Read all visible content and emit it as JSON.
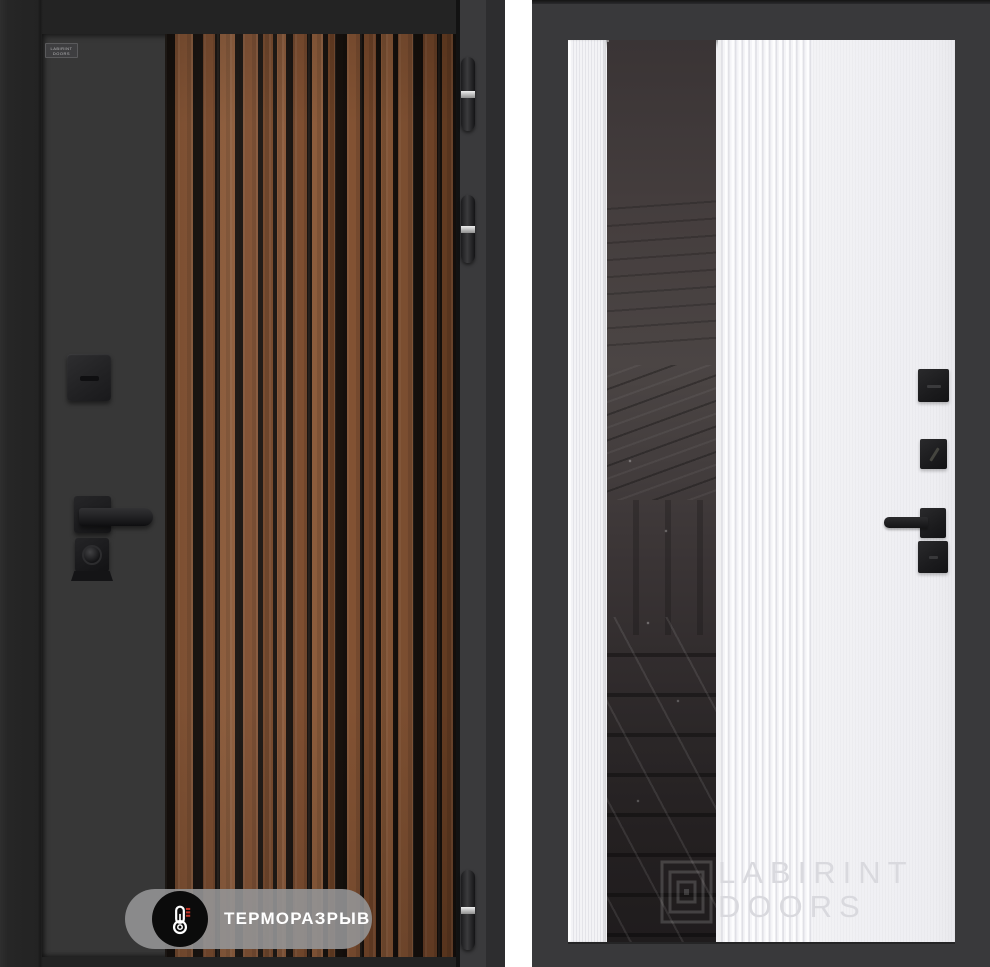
{
  "page": {
    "background": "#ffffff",
    "description_left": "dark entry door with vertical wood slat insert",
    "description_right": "white interior door panel with smoked mirror strip"
  },
  "colors": {
    "wood_gap": "#17110d",
    "wood_a": "#7e4c2d",
    "wood_b": "#8a5736",
    "wood_c": "#744527",
    "wood_d": "#8f5c3a",
    "jamb_light": "#3a3a3c",
    "badge_pill": "rgba(148,148,149,0.9)",
    "badge_circle": "#0b0b0b",
    "badge_text": "#ffffff",
    "thermo_red": "#c23327",
    "right_frame": "#39393b",
    "right_leaf": "#f0f0f3",
    "flute_shadow": "#e0e0e6",
    "mirror_top": "#4b4544",
    "mirror_bottom": "#1f1c1d",
    "watermark_text": "#d9d9de",
    "watermark_logo": "rgba(255,255,255,0.16)"
  },
  "left_door": {
    "logo_plate": {
      "text": "LABIRINT DOORS"
    },
    "badge": {
      "label": "ТЕРМОРАЗРЫВ",
      "icon": "thermometer-icon"
    },
    "hinge_count": 3
  },
  "right_door": {
    "watermark": {
      "line1": "LABIRINT",
      "line2": "DOORS",
      "icon": "labyrinth-logo-icon"
    }
  }
}
